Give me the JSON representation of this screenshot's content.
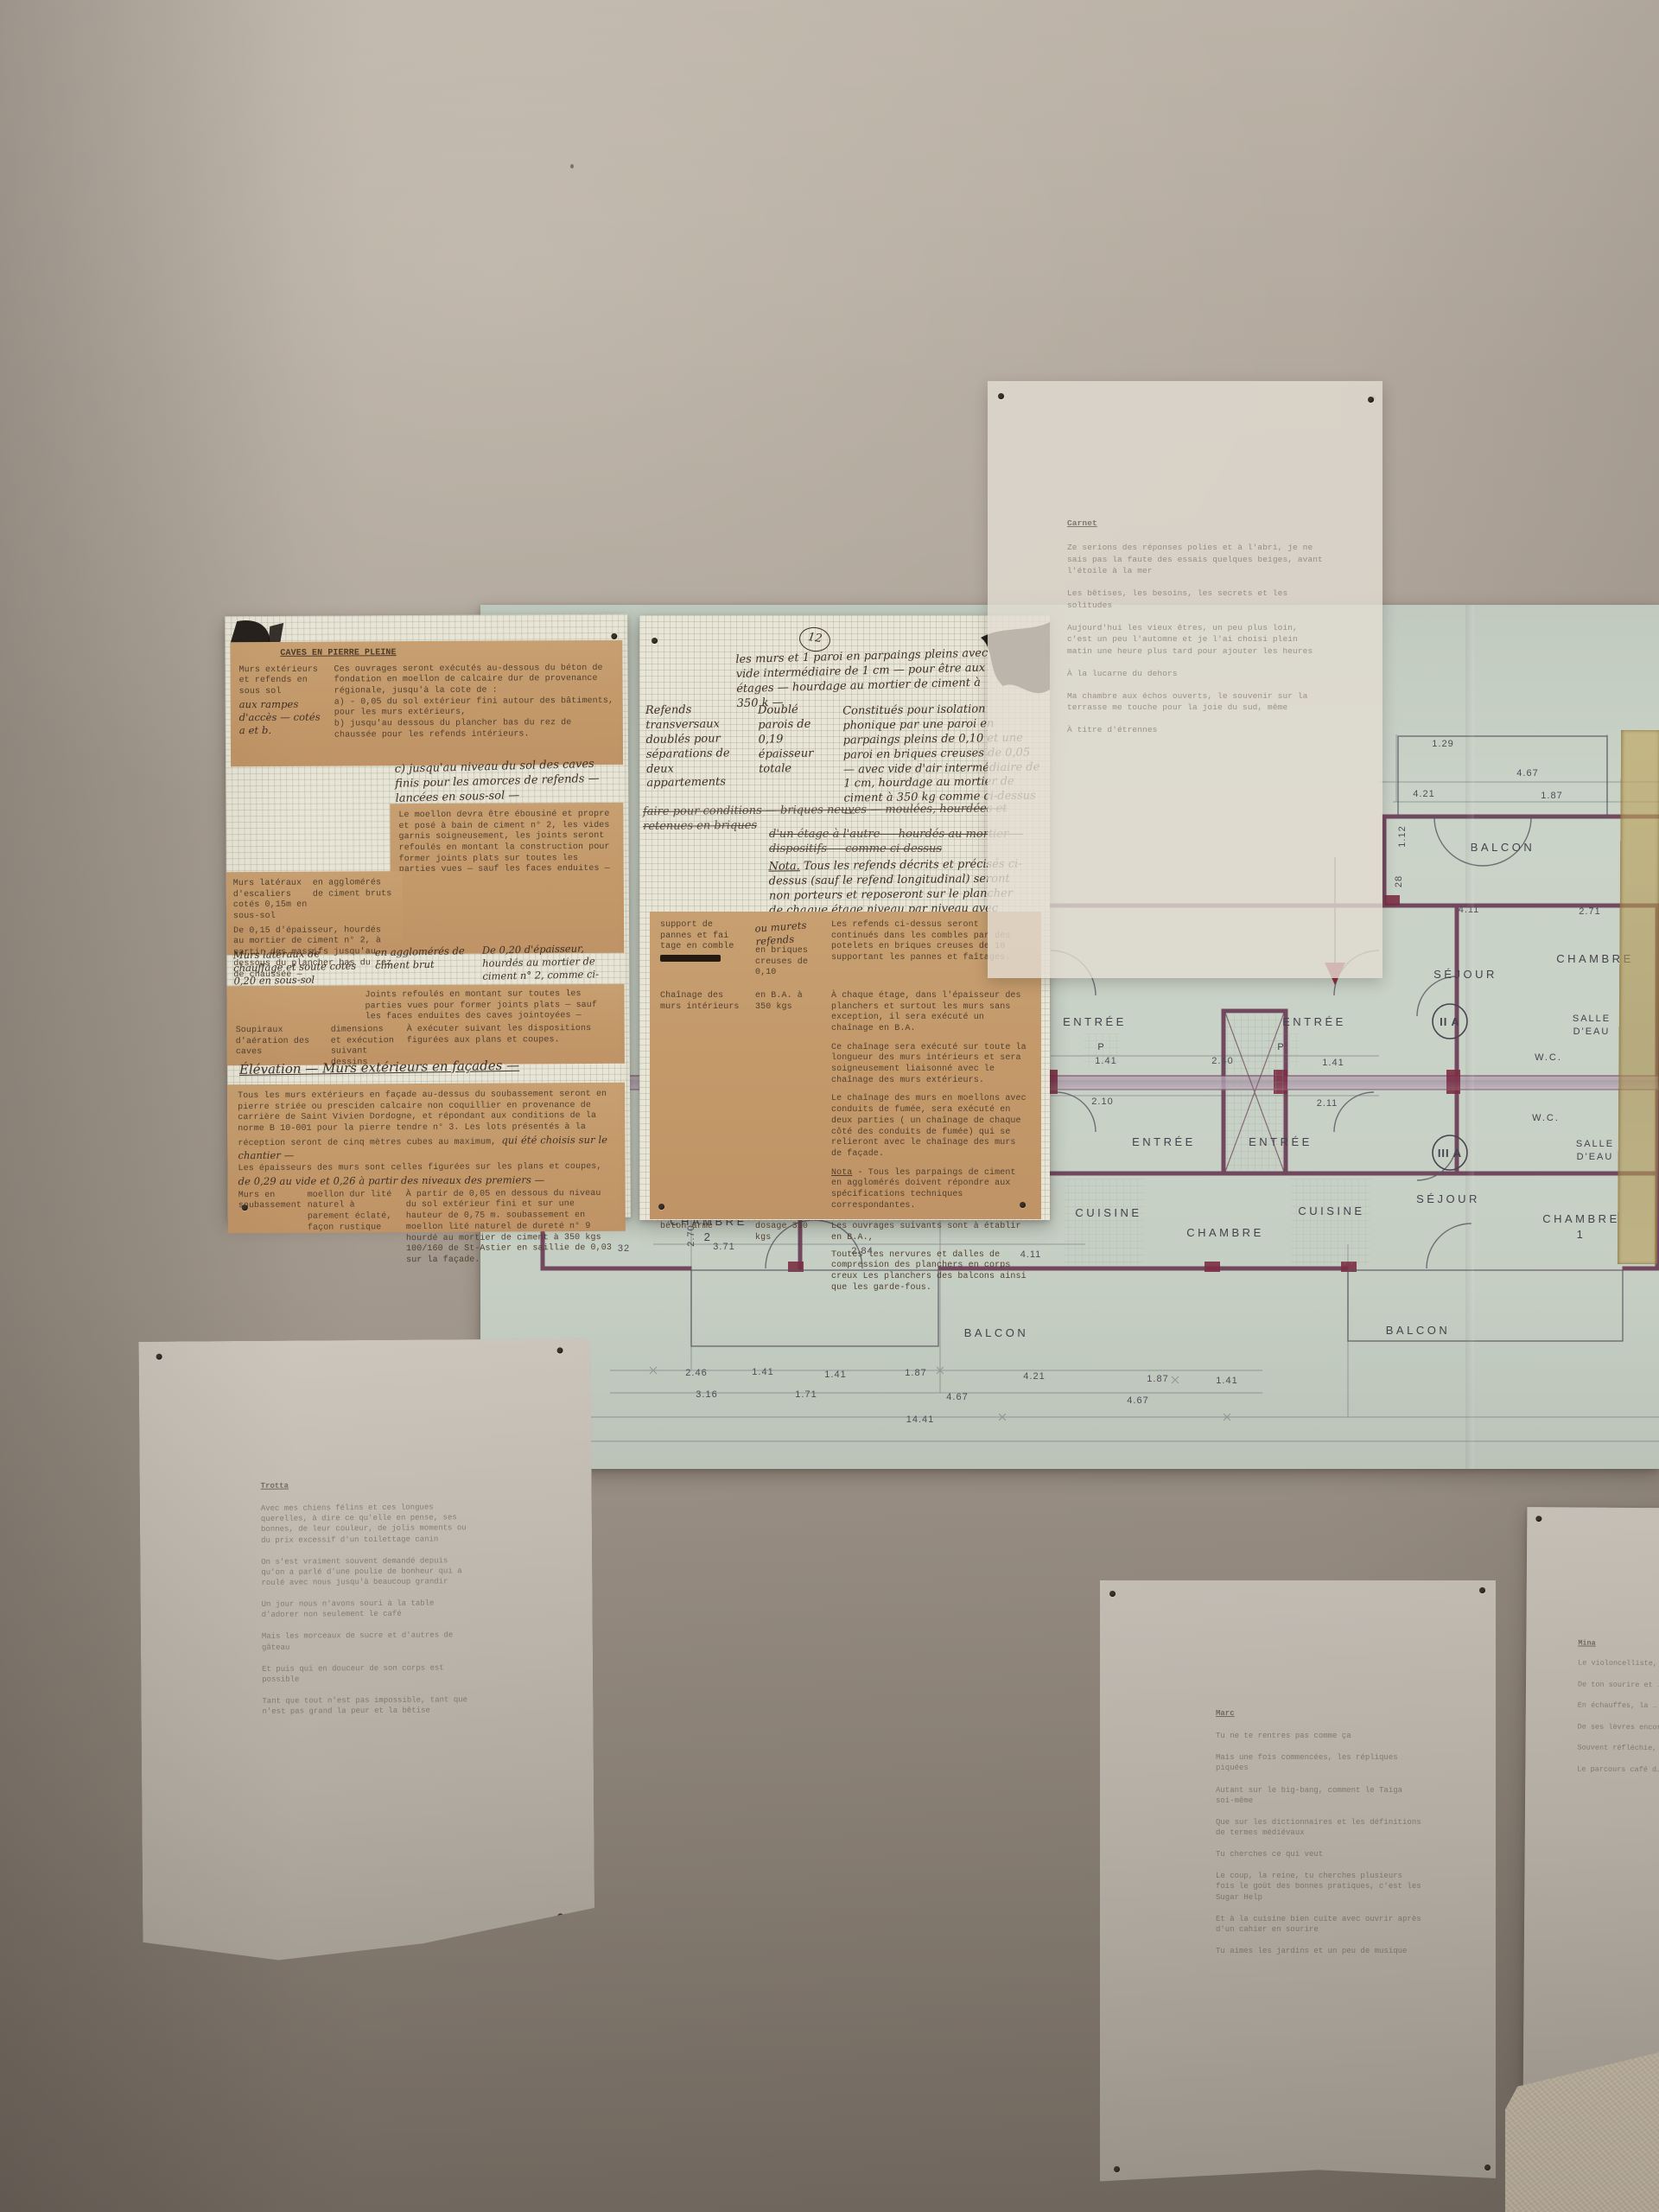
{
  "palette": {
    "wall_top": "#b8aea3",
    "wall_bottom": "#857b71",
    "plan_paper": "#c8d1c6",
    "plan_wall_ink": "#6b3d56",
    "tan_paper": "#c49a6a",
    "graph_paper": "#e9e5d6",
    "typed_ink": "#52402e",
    "tape": "#b59a5e"
  },
  "spec_sheet_left": {
    "title": "CAVES EN PIERRE PLEINE",
    "r1_label": "Murs extérieurs et refends en sous sol",
    "r1_hand": "aux rampes d'accès — cotés a et b.",
    "r1_text": "Ces ouvrages seront exécutés au-dessous du béton de fondation en moellon de calcaire dur de provenance régionale, jusqu'à la cote de :",
    "r1_a": "a) - 0,05 du sol extérieur fini autour des bâtiments, pour les murs extérieurs,",
    "r1_b": "b) jusqu'au dessous du plancher bas du rez de chaussée pour les refends intérieurs.",
    "hand_c": "c) jusqu'au niveau du sol des caves finis pour les amorces de refends — lancées en sous-sol —",
    "moellon": "Le moellon devra être ébousiné et propre et posé à bain de ciment n° 2, les vides garnis soigneusement, les joints seront refoulés en montant la construction pour former joints plats sur toutes les parties vues — sauf les faces enduites —",
    "r2_label": "Murs latéraux d'escaliers cotés 0,15m en sous-sol",
    "r2_mid": "en agglomérés de ciment bruts",
    "r2_text": "De 0,15 d'épaisseur, hourdés au mortier de ciment n° 2, à partir des massifs jusqu'au dessous du plancher bas du rez de chaussée —",
    "hand2_label": "Murs latéraux de chauffage et soute cotés 0,20 en sous-sol",
    "hand2_mid": "en agglomérés de ciment brut",
    "hand2_text": "De 0,20 d'épaisseur, hourdés au mortier de ciment n° 2, comme ci-dessus —",
    "joints": "Joints refoulés en montant sur toutes les parties vues pour former joints plats — sauf les faces enduites des caves jointoyées —",
    "r3_label": "Soupiraux d'aération des caves",
    "r3_mid": "dimensions et exécution suivant dessins",
    "r3_text": "À exécuter suivant les dispositions figurées aux plans et coupes.",
    "hand_heading": "Élévation — Murs extérieurs en façades —",
    "fac_p1": "Tous les murs extérieurs en façade au-dessus du soubassement seront en pierre striée ou presciden calcaire non coquillier en provenance de carrière de Saint Vivien Dordogne, et répondant aux conditions de la norme B 10-001 pour la pierre tendre n° 3. Les lots présentés à la réception seront de cinq mètres cubes au maximum,",
    "fac_hand": "qui été choisis sur le chantier —",
    "fac_p2": "Les épaisseurs des murs sont celles figurées sur les plans et coupes,",
    "fac_hand2": "de 0,29 au vide et 0,26 à partir des niveaux des premiers —",
    "r4_label": "Murs en soubassement",
    "r4_mid": "moellon dur lité naturel à parement éclaté, façon rustique",
    "r4_text": "À partir de 0,05 en dessous du niveau du sol extérieur fini et sur une hauteur de 0,75 m. soubassement en moellon lité naturel de dureté n° 9 hourdé au mortier de ciment à 350 kgs 100/160 de St-Astier en saillie de 0,03 sur la façade."
  },
  "notes_sheet": {
    "page_no": "12",
    "p1": "les murs et 1 paroi en parpaings pleins avec vide intermédiaire de 1 cm — pour être aux étages — hourdage au mortier de ciment à 350 k —",
    "col_label": "Refends transversaux doublés pour séparations de deux appartements",
    "col_mid": "Doublé parois de 0,19 épaisseur totale",
    "col_text": "Constitués pour isolation phonique par une paroi en parpaings pleins de 0,10 et une paroi en briques creuses de 0,05 — avec vide d'air intermédiaire de 1 cm, hourdage au mortier de ciment à 350 kg comme ci-dessus —",
    "struck1": "faire pour conditions — briques neuves — moulées, hourdées et retenues en briques",
    "struck2": "d'un étage à l'autre — hourdés au mortier — dispositifs — comme ci-dessus",
    "nota_label": "Nota.",
    "nota": "Tous les refends décrits et précisés ci-dessus (sauf le refend longitudinal) seront non porteurs et reposeront sur le plancher de chaque étage niveau par niveau avec ossature de renforcement si nécessaire dans les planchers."
  },
  "spec_sheet_middle": {
    "r1_label": "support de pannes et fai tage en comble",
    "r1_hand": "ou murets refends",
    "r1_mid": "en briques creuses de 0,10",
    "r1_text": "Les refends ci-dessus seront continués dans les combles par des potelets en briques creuses de 10 supportant les pannes et faîtages.",
    "r2_label": "Chaînage des murs intérieurs",
    "r2_mid": "en B.A. à 350 kgs",
    "r2_p1": "À chaque étage, dans l'épaisseur des planchers et surtout les murs sans exception, il sera exécuté un chaînage en B.A.",
    "r2_p2": "Ce chaînage sera exécuté sur toute la longueur des murs intérieurs et sera soigneusement liaisonné avec le chaînage des murs extérieurs.",
    "r2_p3": "Le chaînage des murs en moellons avec conduits de fumée, sera exécuté en deux parties ( un chaînage de chaque côté des conduits de fumée) qui se relieront avec le chaînage des murs de façade.",
    "nota_label": "Nota",
    "r2_nota": "- Tous les parpaings de ciment en agglomérés doivent répondre aux spécifications techniques correspondantes.",
    "r3_label": "béton armé",
    "r3_mid": "dosage 350 kgs",
    "r3_p1": "Les ouvrages suivants sont à établir en B.A.,",
    "r3_p2": "Toutes les nervures et dalles de compression des planchers en corps creux Les planchers des balcons ainsi que les garde-fous."
  },
  "floor_plan": {
    "labels": {
      "balcon": "BALCON",
      "sejour": "SÉJOUR",
      "chambre": "CHAMBRE",
      "entree": "ENTRÉE",
      "cuisine": "CUISINE",
      "salle": "SALLE",
      "deau": "D'EAU",
      "wc": "W.C.",
      "p": "P",
      "unit_2a": "II A",
      "unit_3a": "III A",
      "no1": "1",
      "no2": "2"
    },
    "dims": [
      "1.29",
      "4.67",
      "4.21",
      "1.87",
      "4.11",
      "2.71",
      "1.12",
      "28",
      "1.41",
      "2.40",
      "1.41",
      "2.10",
      "2.11",
      "3.71",
      "2.84",
      "4.11",
      "2.70",
      "32",
      "2.46",
      "1.41",
      "1.41",
      "1.87",
      "4.21",
      "1.87",
      "1.41",
      "3.16",
      "1.71",
      "4.67",
      "4.67",
      "14.41"
    ]
  },
  "tracing_sheet": {
    "title": "Carnet",
    "p1": "Ze serions des réponses polies et à l'abri, je ne sais pas la faute des essais quelques beiges, avant l'étoile à la mer",
    "p2": "Les bêtises, les besoins, les secrets et les solitudes",
    "p3": "Aujourd'hui les vieux êtres, un peu plus loin, c'est un peu l'automne et je l'ai choisi plein matin une heure plus tard pour ajouter les heures",
    "p4": "À la lucarne du dehors",
    "p5": "Ma chambre aux échos ouverts, le souvenir sur la terrasse me touche pour la joie du sud, même",
    "p6": "À titre d'étrennes"
  },
  "poem_left": {
    "title": "Trotta",
    "stanzas": [
      "Avec mes chiens félins et ces longues querelles, à dire ce qu'elle en pense, ses bonnes, de leur couleur, de jolis moments ou du prix excessif d'un toilettage canin",
      "On s'est vraiment souvent demandé depuis qu'on a parlé d'une poulie de bonheur qui a roulé avec nous jusqu'à beaucoup grandir",
      "Un jour nous n'avons souri à la table d'adorer non seulement le café",
      "Mais les morceaux de sucre et d'autres de gâteau",
      "Et puis qui en douceur de son corps est possible",
      "Tant que tout n'est pas impossible, tant que n'est pas grand la peur et la bêtise"
    ]
  },
  "poem_middle": {
    "title": "Marc",
    "stanzas": [
      "Tu ne te rentres pas comme ça",
      "Mais une fois commencées, les répliques piquées",
      "Autant sur le big-bang, comment le Taïga soi-même",
      "Que sur les dictionnaires et les définitions de termes médiévaux",
      "Tu cherches ce qui veut",
      "Le coup, la reine, tu cherches plusieurs fois le goût des bonnes pratiques, c'est les Sugar Help",
      "Et à la cuisine bien cuite avec ouvrir après d'un cahier en sourire",
      "Tu aimes les jardins et un peu de musique"
    ]
  },
  "poem_right": {
    "title": "Mina",
    "stanzas": [
      "Le violoncelliste, b…",
      "De ton sourire et … tous les jours",
      "En échauffes, la … retrouvez le …",
      "De ses lèvres encore …",
      "Souvent réfléchie, …",
      "Le parcours café d…"
    ]
  }
}
